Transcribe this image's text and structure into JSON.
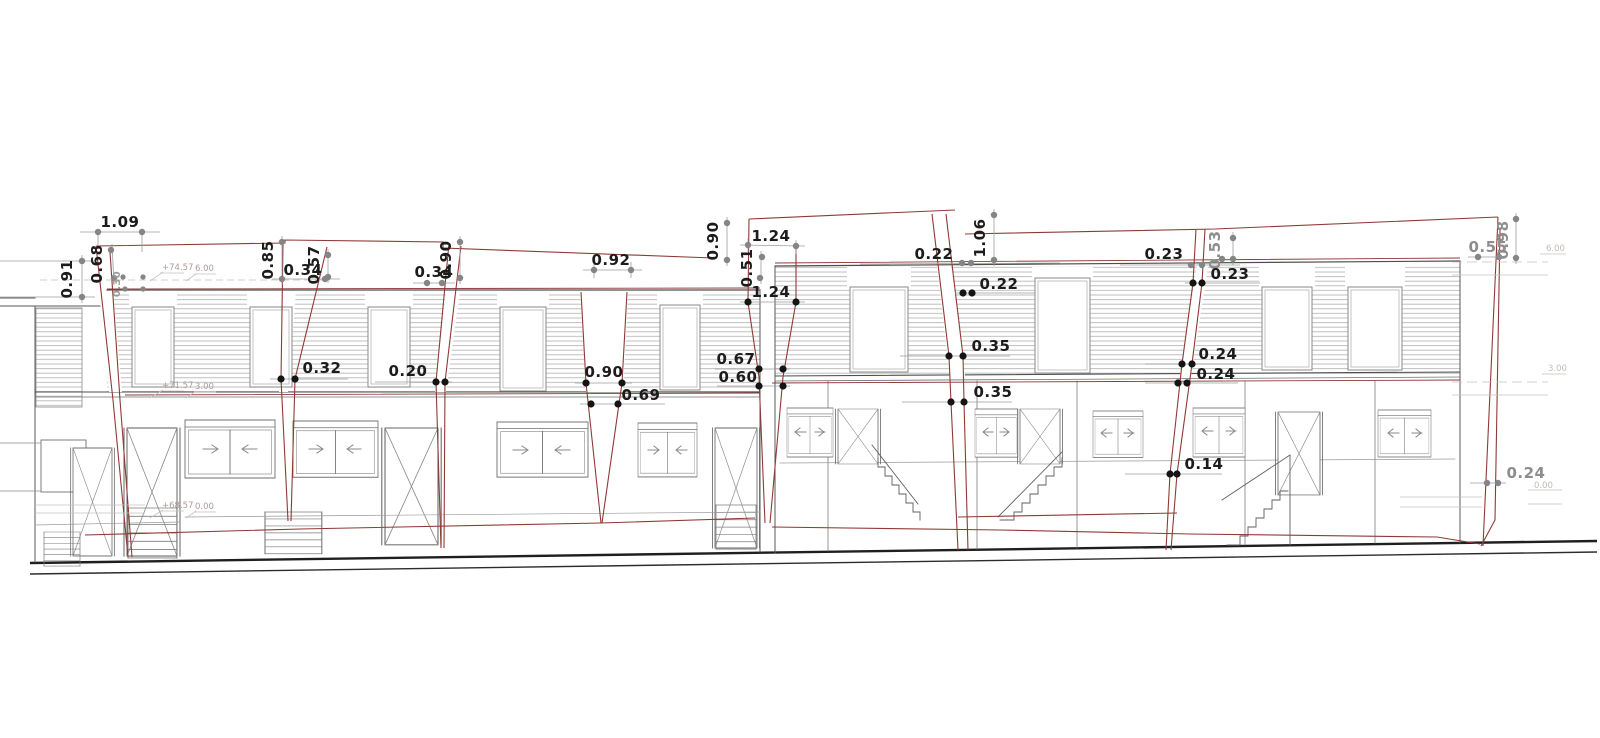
{
  "drawing": {
    "type": "building-elevation-survey",
    "colors": {
      "overlay_red": "#8e3a35",
      "outline": "#4f4f4f",
      "hatch": "#b8b8b8",
      "dot_black": "#141414",
      "dot_gray": "#858585",
      "text_black": "#1c1c1c",
      "text_gray": "#8d8d8d",
      "level_text": "#ab9c96"
    }
  },
  "dims": [
    {
      "v": "1.09"
    },
    {
      "v": "0.91"
    },
    {
      "v": "0.68"
    },
    {
      "v": "0.30"
    },
    {
      "v": "0.85"
    },
    {
      "v": "0.34"
    },
    {
      "v": "0.57"
    },
    {
      "v": "0.34"
    },
    {
      "v": "0.90"
    },
    {
      "v": "0.92"
    },
    {
      "v": "0.90"
    },
    {
      "v": "1.24"
    },
    {
      "v": "0.51"
    },
    {
      "v": "1.24"
    },
    {
      "v": "0.22"
    },
    {
      "v": "1.06"
    },
    {
      "v": "0.22"
    },
    {
      "v": "0.23"
    },
    {
      "v": "0.53"
    },
    {
      "v": "0.23"
    },
    {
      "v": "0.55"
    },
    {
      "v": "0.98"
    },
    {
      "v": "0.32"
    },
    {
      "v": "0.20"
    },
    {
      "v": "0.90"
    },
    {
      "v": "0.69"
    },
    {
      "v": "0.67"
    },
    {
      "v": "0.60"
    },
    {
      "v": "0.35"
    },
    {
      "v": "0.35"
    },
    {
      "v": "0.24"
    },
    {
      "v": "0.24"
    },
    {
      "v": "0.14"
    },
    {
      "v": "0.24"
    }
  ],
  "levels_left": [
    {
      "abs": "+74.57",
      "rel": "6.00"
    },
    {
      "abs": "+71.57",
      "rel": "3.00"
    },
    {
      "abs": "+68.57",
      "rel": "0.00"
    }
  ],
  "levels_right": [
    {
      "v": "6.00"
    },
    {
      "v": "3.00"
    },
    {
      "v": "0.00"
    }
  ]
}
